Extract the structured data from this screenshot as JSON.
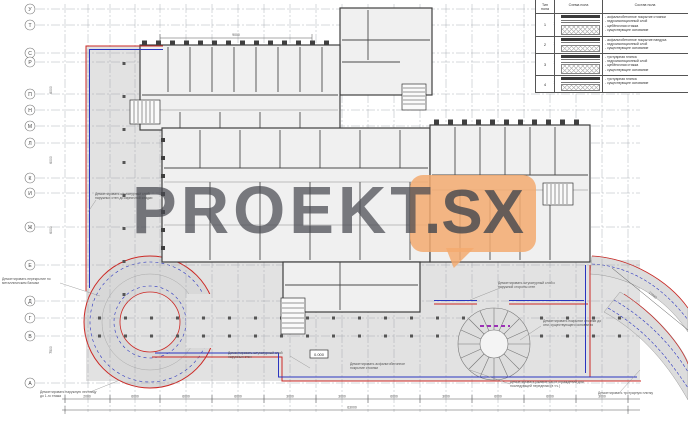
{
  "watermark": {
    "main": "PROEKT",
    "suffix": ".SX",
    "bubble_color": "#f3aa70",
    "text_color": "#4a4c50"
  },
  "legend": {
    "headers": {
      "col1": "Тип пола",
      "col2": "Схема пола",
      "col3": "Состав пола"
    },
    "rows": [
      {
        "num": "1",
        "comp": [
          "- асфальтобетонное покрытие стоянки",
          "- гидроизоляционный слой",
          "- щебёночная стяжка",
          "- существующее основание"
        ]
      },
      {
        "num": "2",
        "comp": [
          "- асфальтобетонное покрытие пандуса",
          "- гидроизоляционный слой",
          "- существующее основание"
        ]
      },
      {
        "num": "3",
        "comp": [
          "- тротуарная плитка",
          "- гидроизоляционный слой",
          "- щебёночная стяжка",
          "- существующее основание"
        ]
      },
      {
        "num": "4",
        "comp": [
          "- тротуарная плитка",
          "- существующее основание"
        ]
      }
    ]
  },
  "axes": {
    "rows": [
      "У",
      "Т",
      "С",
      "Р",
      "П",
      "Н",
      "М",
      "Л",
      "К",
      "И",
      "Ж",
      "Е",
      "Д",
      "Г",
      "В",
      "А"
    ]
  },
  "dims": {
    "top": "9000",
    "diag": "17040",
    "total": "63000",
    "elevation": "0.000",
    "chain": [
      "2000",
      "6000",
      "6000",
      "6000",
      "3000",
      "3000",
      "6000",
      "3000",
      "6000",
      "6000",
      "3000"
    ],
    "left": [
      "6000",
      "6000",
      "6000",
      "7500"
    ]
  },
  "annotations": [
    "Демонтировать штукатурный слой наружных стен до кирпичной кладки",
    "Демонтировать перекрытие по металлическим балкам",
    "Демонтировать наружную лестницу до 1-го этажа",
    "Демонтировать штукатурный слой наружных стен",
    "Демонтировать асфальтобетонное покрытие стоянки",
    "Демонтировать штукатурный слой с наружной стороны стен",
    "Демонтировать покрытие стоянки до отм. существующего основания",
    "Демонтировать ржавые части ограждений для последующей переделки (в т.ч.)",
    "Демонтировать тротуарную плитку"
  ],
  "colors": {
    "demolition_red": "#cc2824",
    "demolition_blue": "#2b35c0",
    "purple_dashed": "#9b30b5",
    "building_fill": "#f0f0f0",
    "apron_fill": "#e2e2e2",
    "wall": "#3f3f3f"
  }
}
